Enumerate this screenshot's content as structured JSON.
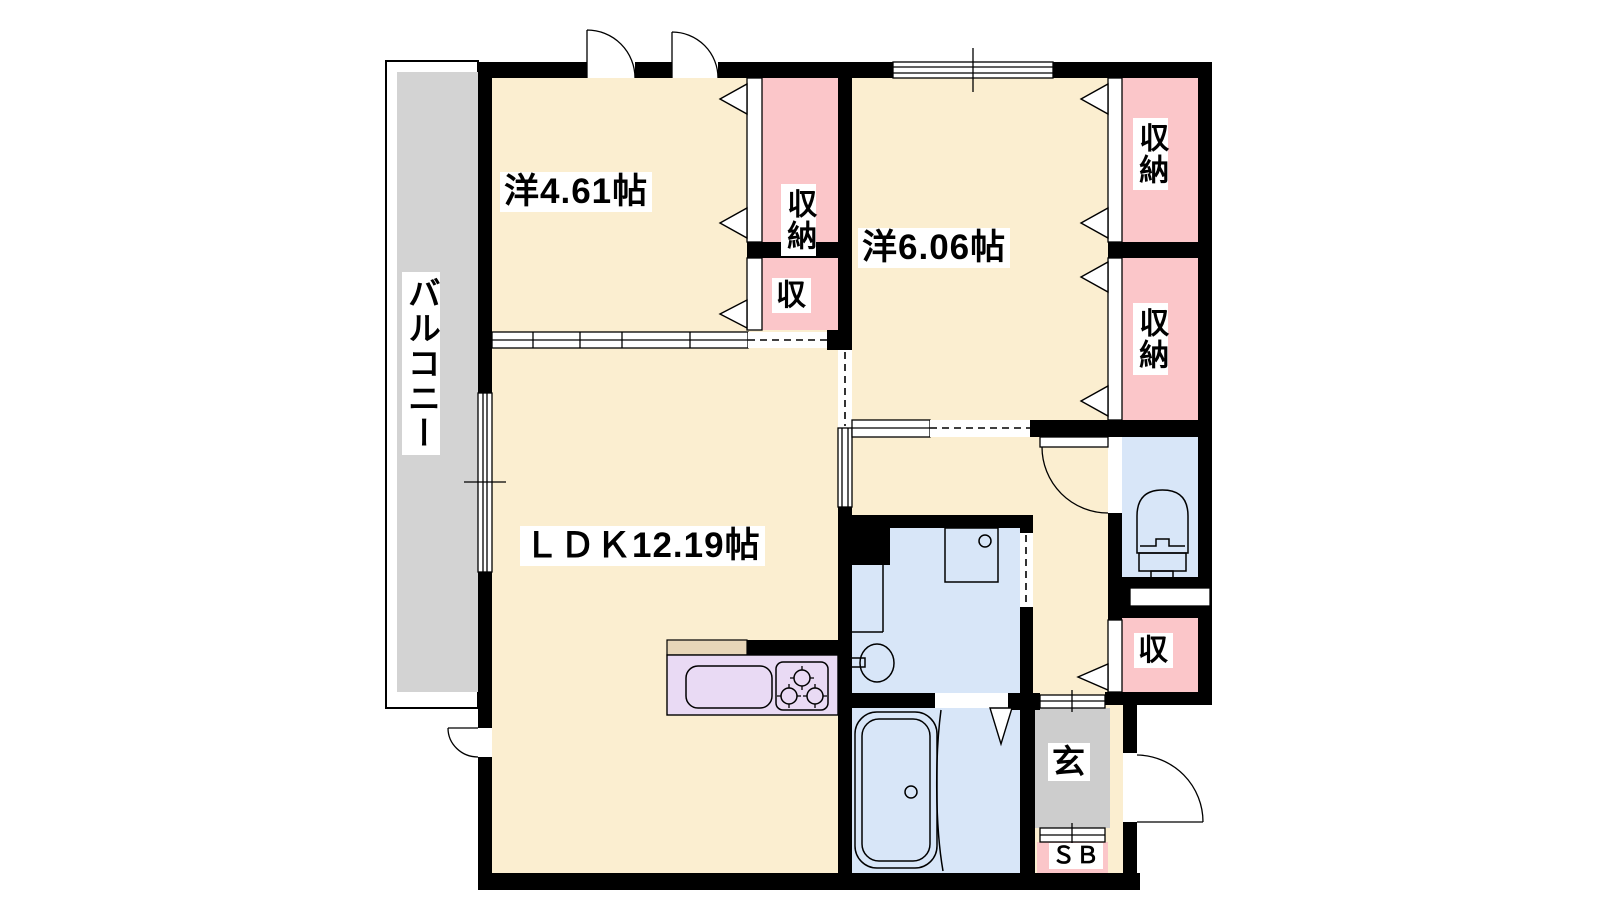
{
  "plan": {
    "rooms": {
      "western1": {
        "label": "洋4.61帖"
      },
      "western2": {
        "label": "洋6.06帖"
      },
      "ldk": {
        "label": "ＬＤＫ12.19帖"
      },
      "balcony": {
        "label": "バルコニー"
      },
      "entrance": {
        "label": "玄"
      },
      "shoebox": {
        "label": "ＳＢ"
      }
    },
    "closets": [
      {
        "label": "収納"
      },
      {
        "label": "収"
      },
      {
        "label": "収納"
      },
      {
        "label": "収納"
      },
      {
        "label": "収"
      }
    ],
    "colors": {
      "floor": "#FBEED0",
      "closet": "#FBC6C9",
      "wet_area": "#D8E6F8",
      "balcony": "#D3D3D3",
      "entrance_floor": "#CDCDCD",
      "kitchen_counter": "#E9DAF4",
      "kitchen_top": "#E7D6B8",
      "wall": "#000000",
      "label_bg": "#FFFFFF"
    }
  }
}
